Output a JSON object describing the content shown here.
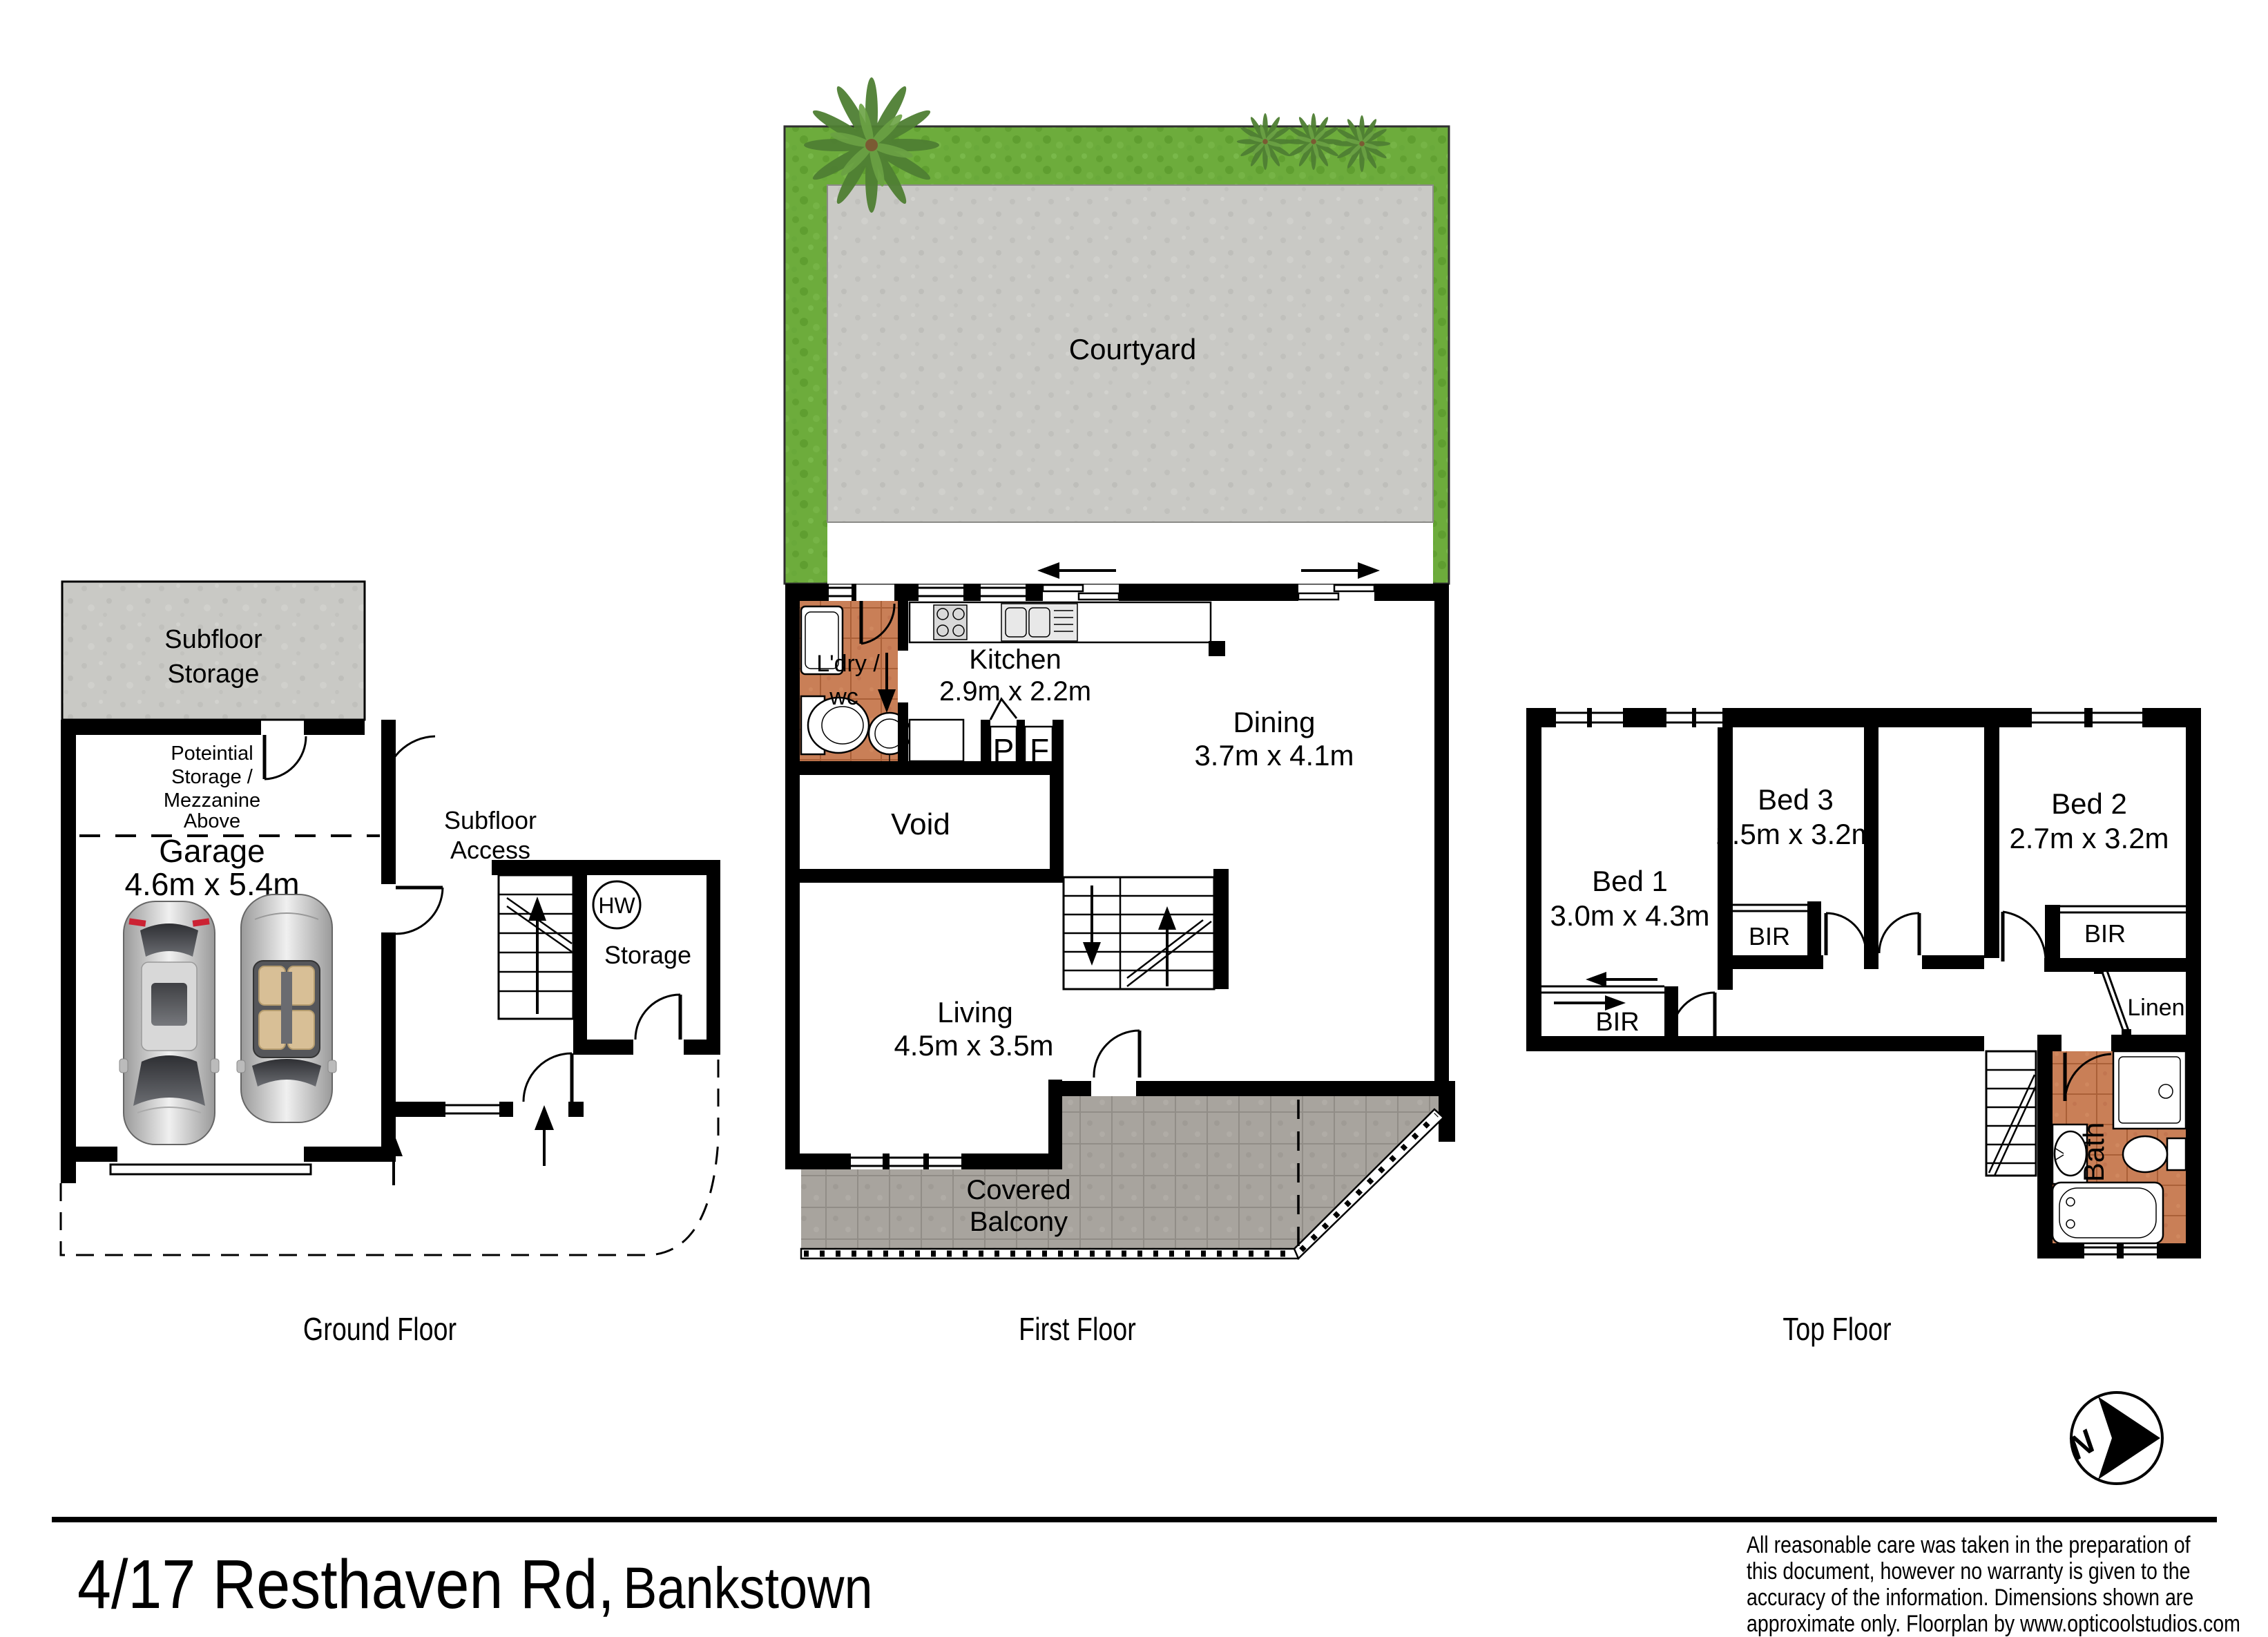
{
  "colors": {
    "wall": "#000000",
    "grass": "#6dac3c",
    "concrete": "#c9c9c5",
    "paving": "#a8a49e",
    "terracotta": "#c97f57"
  },
  "address": {
    "main": "4/17 Resthaven Rd,",
    "suburb": "Bankstown"
  },
  "compass": {
    "letter": "N"
  },
  "captions": {
    "ground": "Ground Floor",
    "first": "First Floor",
    "top": "Top Floor"
  },
  "ground": {
    "subfloor_storage_lines": [
      "Subfloor",
      "Storage"
    ],
    "potential_lines": [
      "Poteintial",
      "Storage /",
      "Mezzanine",
      "Above"
    ],
    "garage_label": "Garage",
    "garage_dims": "4.6m x 5.4m",
    "subfloor_access_lines": [
      "Subfloor",
      "Access"
    ],
    "hw_label": "HW",
    "storage_label": "Storage"
  },
  "first": {
    "courtyard_label": "Courtyard",
    "ldry_lines": [
      "L'dry /",
      "wc"
    ],
    "kitchen_label": "Kitchen",
    "kitchen_dims": "2.9m x 2.2m",
    "pantry_label": "P",
    "fridge_label": "F",
    "dining_label": "Dining",
    "dining_dims": "3.7m x 4.1m",
    "void_label": "Void",
    "living_label": "Living",
    "living_dims": "4.5m x 3.5m",
    "balcony_lines": [
      "Covered",
      "Balcony"
    ]
  },
  "top": {
    "bed1_label": "Bed 1",
    "bed1_dims": "3.0m x 4.3m",
    "bed3_label": "Bed 3",
    "bed3_dims": "2.5m x 3.2m",
    "bed2_label": "Bed 2",
    "bed2_dims": "2.7m x 3.2m",
    "bir_bed1": "BIR",
    "bir_bed3": "BIR",
    "bir_bed2": "BIR",
    "linen_label": "Linen",
    "bath_label": "Bath"
  },
  "footer": {
    "disclaimer_lines": [
      "All reasonable care was taken in the preparation of",
      "this document, however no warranty is given to the",
      "accuracy of the information. Dimensions shown are",
      "approximate only. Floorplan by www.opticoolstudios.com"
    ]
  }
}
